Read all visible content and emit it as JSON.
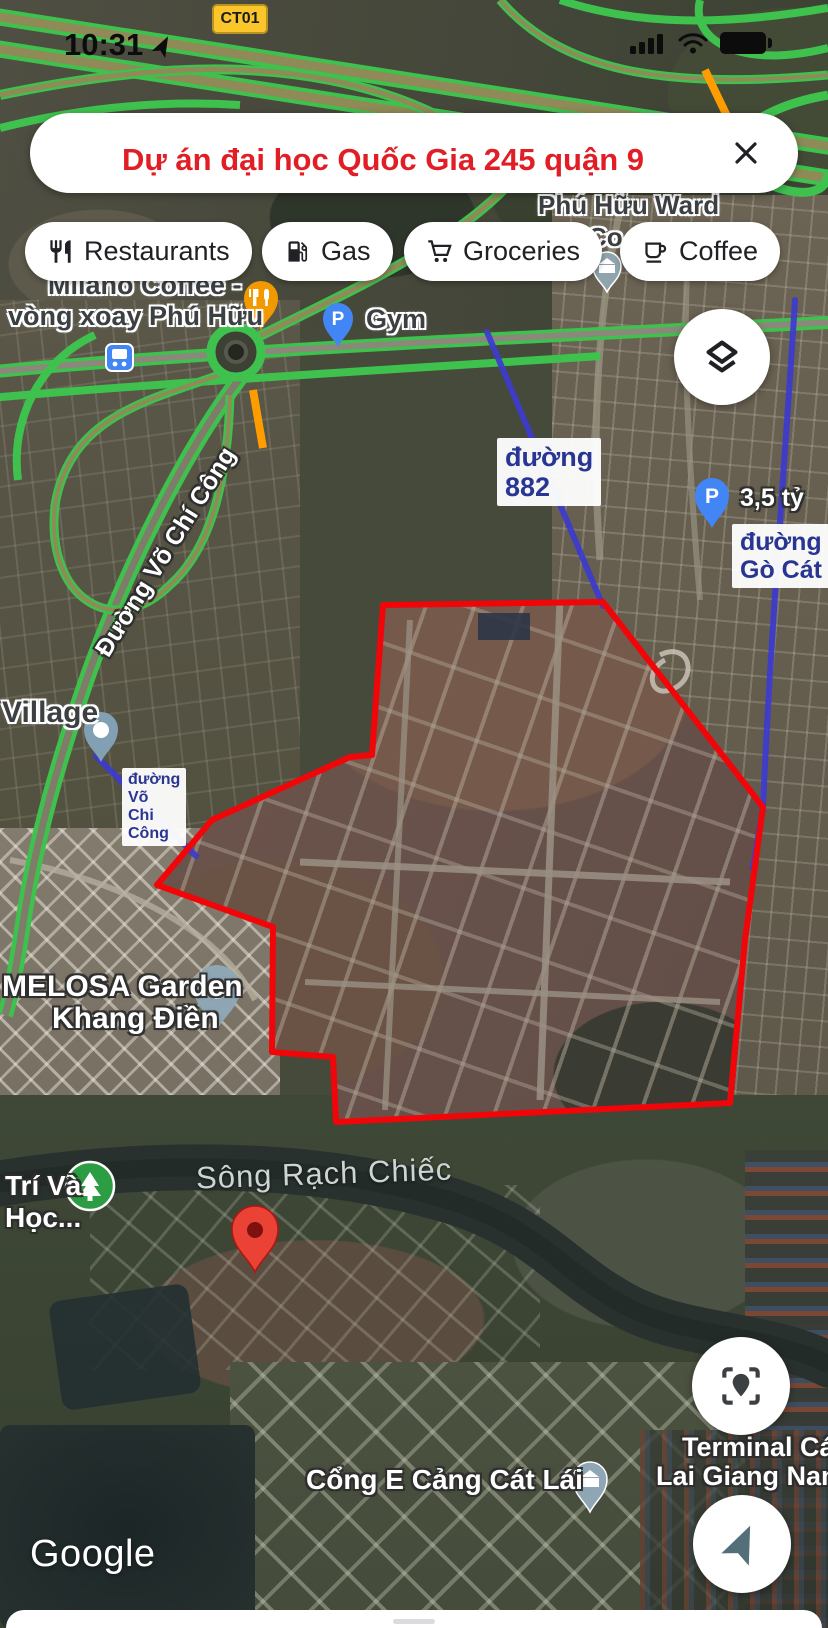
{
  "status_bar": {
    "time": "10:31"
  },
  "route_badge": "CT01",
  "search": {
    "query": "Dự án đại học Quốc Gia 245 quận 9"
  },
  "chips": [
    {
      "label": "Restaurants"
    },
    {
      "label": "Gas"
    },
    {
      "label": "Groceries"
    },
    {
      "label": "Coffee"
    }
  ],
  "map_labels": {
    "phu_huu_ward": "Phú Hữu Ward",
    "phu_huu_ward_line2": "Co...",
    "milano_line1": "Milano Coffee -",
    "milano_line2": "vòng xoay Phú Hữu",
    "gym": "Gym",
    "duong_882_line1": "đường",
    "duong_882_line2": "882",
    "price_tag": "3,5 tỷ",
    "go_cat_line1": "đường",
    "go_cat_line2": "Gò Cát",
    "village": "Village",
    "vo_chi_cong_road": "Đường Võ Chí Công",
    "vcc_line1": "đường",
    "vcc_line2": "Võ",
    "vcc_line3": "Chi",
    "vcc_line4": "Công",
    "melosa_line1": "MELOSA Garden",
    "melosa_line2": "Khang Điền",
    "river": "Sông Rạch Chiếc",
    "tri_va_line1": "Trí Và",
    "tri_va_line2": "Học...",
    "terminal_line1": "Terminal Cát",
    "terminal_line2": "Lai Giang Nam",
    "cong_e": "Cổng E Cảng Cát Lái"
  },
  "pins": {
    "parking_glyph": "P"
  },
  "attribution": {
    "logo": "Google"
  },
  "colors": {
    "selection_outline": "#ff0505",
    "annotation_line": "#3d3bcf",
    "search_text": "#e11e25",
    "label_blue": "#283593",
    "traffic_green": "#3fc14e",
    "traffic_orange": "#ff9d00",
    "traffic_red": "#e53935",
    "route_badge_bg": "#fbc62c"
  }
}
